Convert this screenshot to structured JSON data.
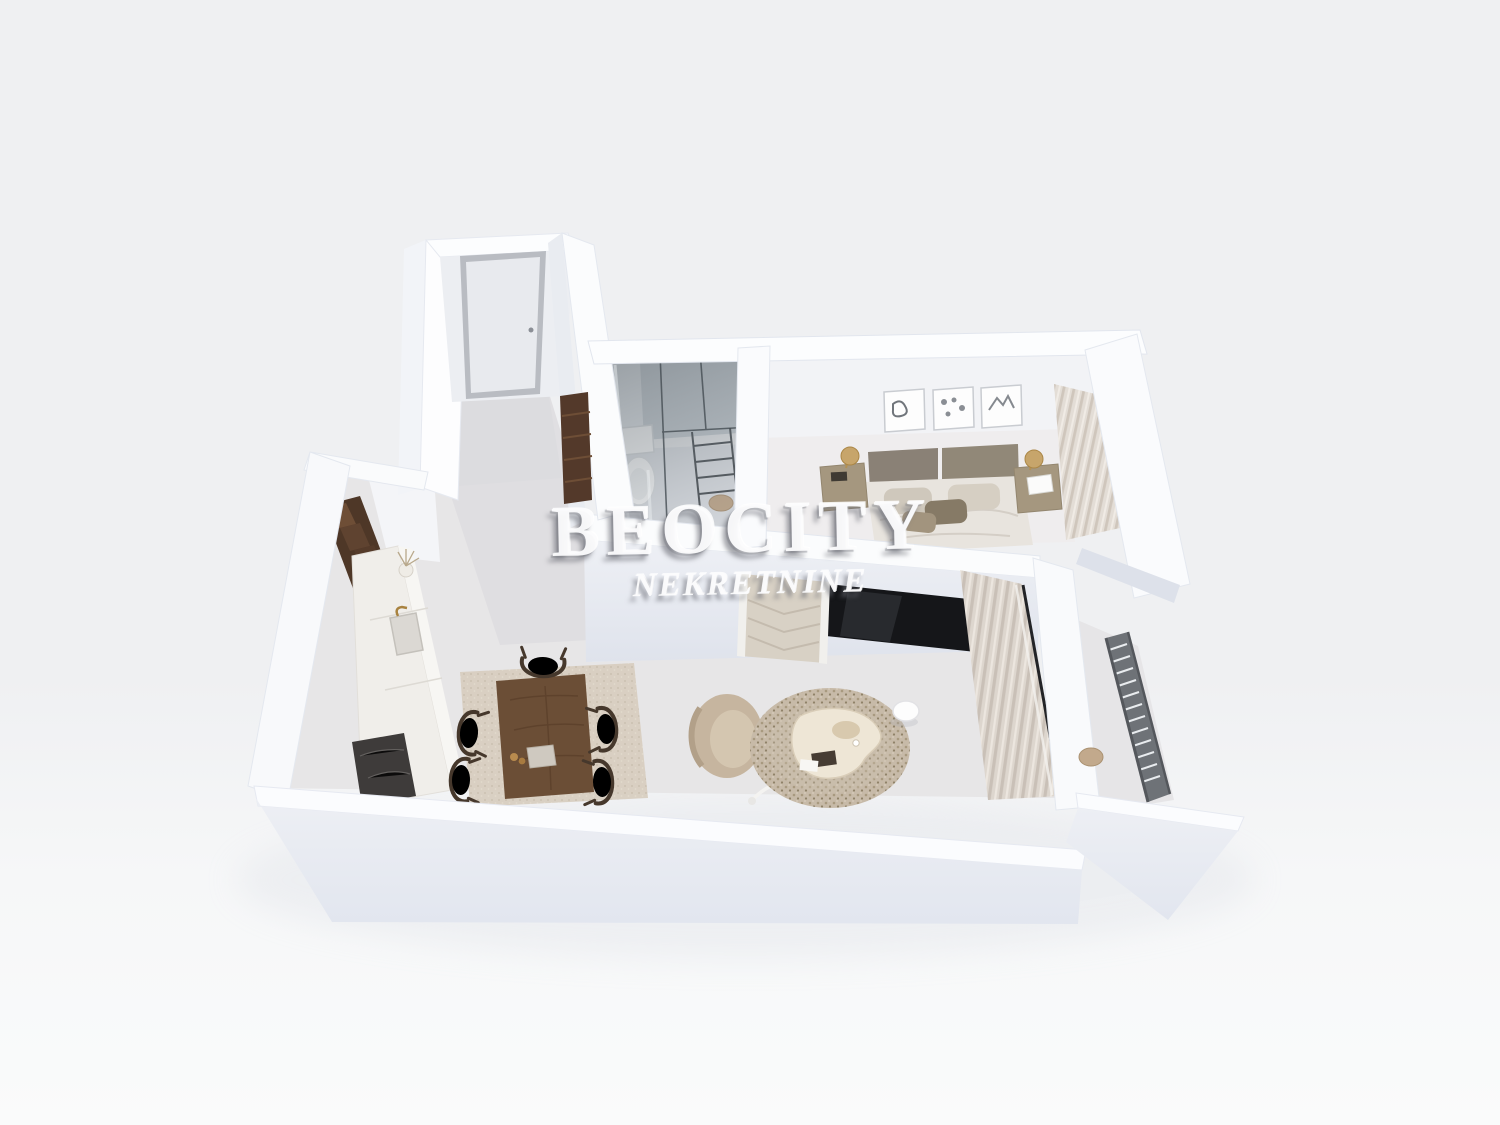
{
  "watermark": {
    "line1": "BEOCITY",
    "line2": "NEKRETNINE"
  },
  "scene": {
    "title": "3D dollhouse-view rendering of a studio apartment floor plan",
    "rooms": [
      {
        "name": "entrance-hall",
        "features": [
          "entrance-door",
          "dark-wood-wardrobe"
        ]
      },
      {
        "name": "bathroom",
        "features": [
          "glass-walk-in-shower",
          "toilet",
          "towel-ladder",
          "wooden-stool"
        ]
      },
      {
        "name": "bedroom",
        "features": [
          "double-bed",
          "headboard",
          "nightstand-left",
          "nightstand-right",
          "gold-table-lamps",
          "three-framed-pictures",
          "window-curtains"
        ]
      },
      {
        "name": "living-dining-room",
        "features": [
          "tv-panel",
          "chevron-sideboard",
          "dining-table",
          "five-wire-chairs",
          "dining-rug",
          "barrel-armchair",
          "round-speckled-rug",
          "organic-coffee-table",
          "side-table",
          "floor-lamp",
          "window-curtains"
        ]
      },
      {
        "name": "kitchen",
        "features": [
          "tall-dark-cabinets",
          "white-countertop",
          "sink",
          "dark-cooktop",
          "vase-with-dried-plant"
        ]
      },
      {
        "name": "balcony",
        "features": [
          "metal-slat-railing",
          "round-stool"
        ]
      }
    ],
    "colors": {
      "background": "#eff0f2",
      "wall_top": "#fcfdfe",
      "wall_face": "#e7eaf1",
      "wall_shadow": "#dde1ea",
      "floor_hall": "#dedde0",
      "floor_living": "#e9e7e8",
      "floor_bedroom": "#efedee",
      "wood_dark": "#4e3727",
      "wood_table": "#6b4e36",
      "textile_beige": "#d8cec0",
      "rug_round": "#c7baa8",
      "tv_black": "#151619",
      "brass": "#c7a56b",
      "railing_gray": "#6e7277",
      "glass_gray": "#6a747b"
    }
  }
}
